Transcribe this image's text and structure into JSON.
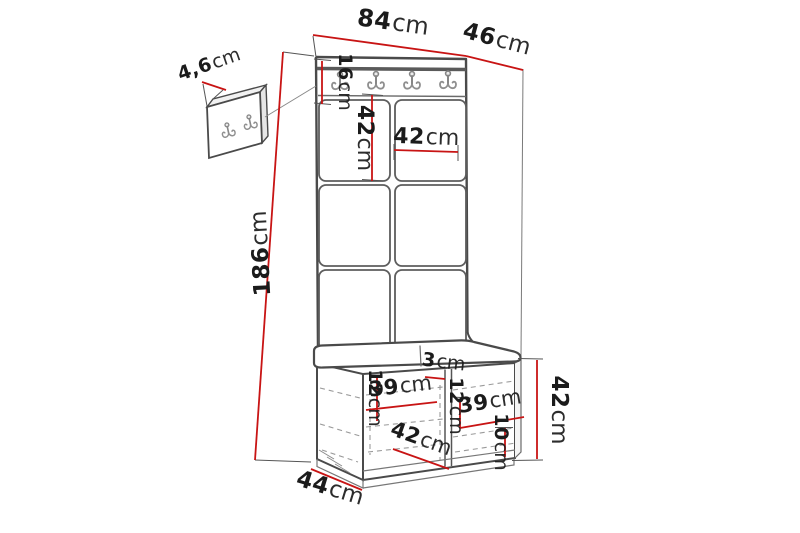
{
  "colors": {
    "dimension_red": "#c81414",
    "text": "#1b1b1b",
    "line_dark": "#4a4a4a",
    "line_mid": "#6e6e6e",
    "hook_gray": "#8a8a8a",
    "dash_gray": "#9a9a9a"
  },
  "dims": {
    "total_width": {
      "num": "84",
      "unit": "cm"
    },
    "total_depth": {
      "num": "46",
      "unit": "cm"
    },
    "panel_thickness": {
      "num": "4,6",
      "unit": "cm"
    },
    "rail_height": {
      "num": "16",
      "unit": "cm"
    },
    "panel_height": {
      "num": "42",
      "unit": "cm"
    },
    "panel_width": {
      "num": "42",
      "unit": "cm"
    },
    "total_height": {
      "num": "186",
      "unit": "cm"
    },
    "divider_thickness": {
      "num": "3",
      "unit": "cm"
    },
    "left_compartment_height": {
      "num": "12",
      "unit": "cm"
    },
    "left_compartment_width": {
      "num": "39",
      "unit": "cm"
    },
    "right_compartment_height": {
      "num": "12",
      "unit": "cm"
    },
    "right_compartment_width": {
      "num": "39",
      "unit": "cm"
    },
    "bench_inner_depth": {
      "num": "42",
      "unit": "cm"
    },
    "base_height": {
      "num": "10",
      "unit": "cm"
    },
    "bench_height": {
      "num": "42",
      "unit": "cm"
    },
    "bench_depth": {
      "num": "44",
      "unit": "cm"
    }
  }
}
